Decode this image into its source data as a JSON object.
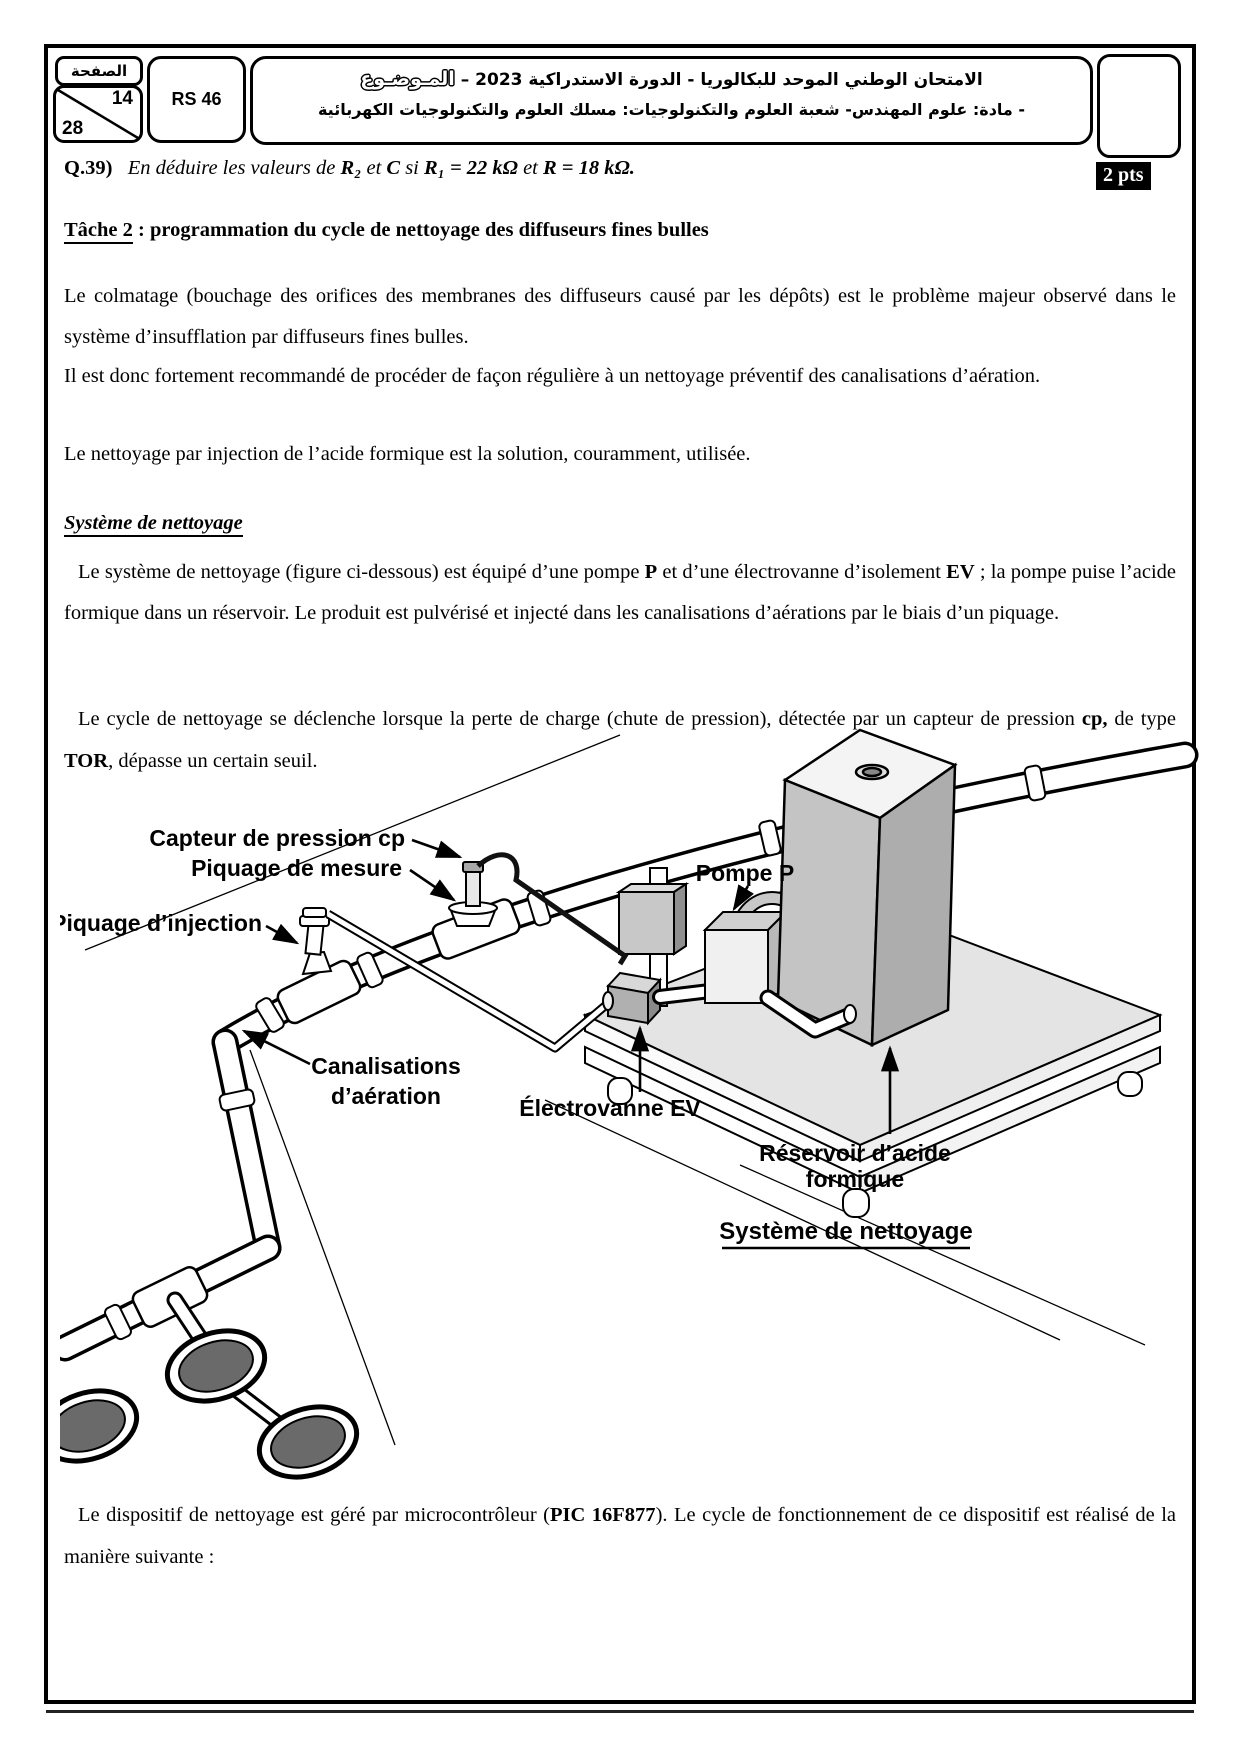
{
  "header": {
    "page_label": "الصفحة",
    "page_number": "14",
    "page_total": "28",
    "reference": "RS 46",
    "title_line1": "الامتحان الوطني الموحد للبكالوريا - الدورة الاستدراكية 2023 –",
    "title_subject": "المـوضـوع",
    "title_line2": "- مادة: علوم المهندس- شعبة العلوم والتكنولوجيات: مسلك العلوم والتكنولوجيات الكهربائية"
  },
  "question": {
    "number": "Q.39)",
    "part1": "En déduire les valeurs de ",
    "bold1": "R₂",
    "part2": " et ",
    "bold2": "C",
    "part3": " si ",
    "bold3": "R₁ = 22 kΩ",
    "part4": " et ",
    "bold4": "R = 18 kΩ.",
    "points": "2 pts"
  },
  "tache2": {
    "title_name": "Tâche 2",
    "title_rest": " : programmation du cycle de nettoyage des diffuseurs fines bulles"
  },
  "paragraphs": {
    "p1": "Le colmatage (bouchage des orifices des membranes des diffuseurs causé par les dépôts) est le problème majeur observé dans le système d’insufflation par diffuseurs fines bulles.",
    "p2": "Il est donc fortement recommandé de procéder de façon régulière à un nettoyage préventif des canalisations d’aération.",
    "p3": "Le nettoyage par injection de l’acide formique est la solution, couramment, utilisée."
  },
  "system_section": {
    "title": "Système de nettoyage",
    "p4_a": "Le système de nettoyage (figure ci-dessous) est équipé d’une pompe ",
    "p4_b1": "P",
    "p4_b": "  et d’une électrovanne d’isolement ",
    "p4_b2": "EV",
    "p4_c": " ; la pompe puise l’acide formique dans un réservoir. Le produit est pulvérisé et injecté dans les canalisations d’aérations par le biais d’un piquage.",
    "p5_a": "Le cycle de nettoyage se déclenche lorsque la perte de charge (chute de pression), détectée par un capteur de pression ",
    "p5_b1": "cp,",
    "p5_b": " de type ",
    "p5_b2": "TOR",
    "p5_c": ", dépasse un certain seuil."
  },
  "diagram": {
    "labels": {
      "capteur": "Capteur de pression cp",
      "piquage_mesure": "Piquage de mesure",
      "pompe": "Pompe P",
      "piquage_injection": "Piquage d’injection",
      "canalisations_1": "Canalisations",
      "canalisations_2": "d’aération",
      "electrovanne": "Électrovanne EV",
      "reservoir_1": "Réservoir d’acide",
      "reservoir_2": "formique",
      "caption": "Système de nettoyage"
    }
  },
  "footer": {
    "p6_a": "Le dispositif de nettoyage est géré par microcontrôleur (",
    "p6_b1": "PIC 16F877",
    "p6_b": "). Le cycle de fonctionnement de ce dispositif est réalisé de la manière suivante :"
  }
}
